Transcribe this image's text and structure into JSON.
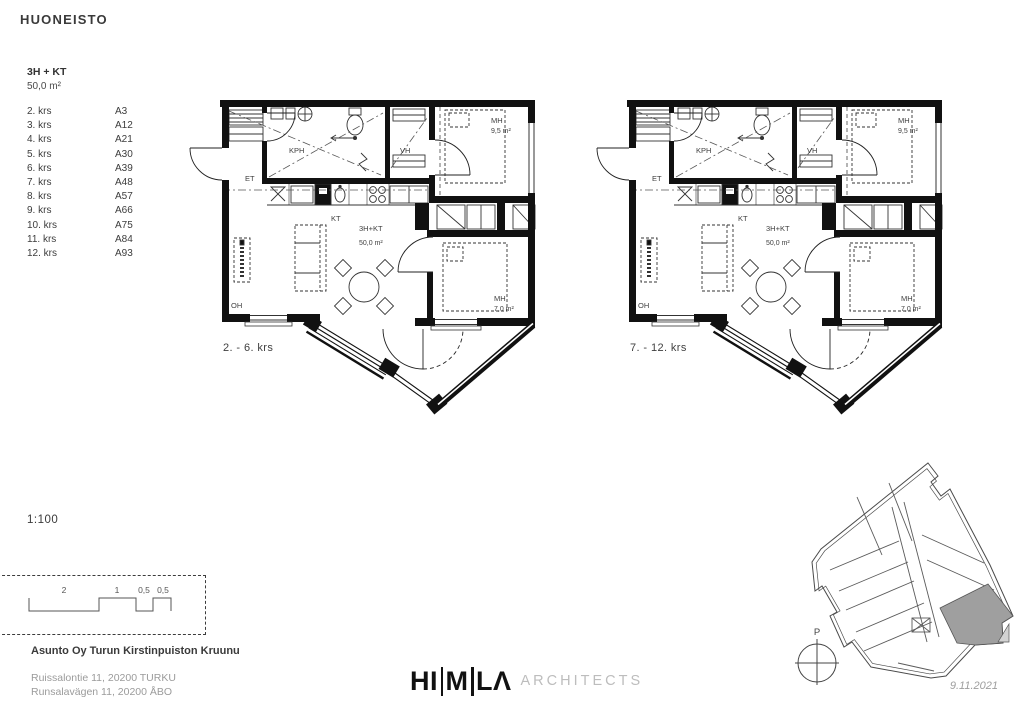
{
  "page": {
    "title": "HUONEISTO",
    "scale_label": "1:100",
    "date": "9.11.2021"
  },
  "unit": {
    "type": "3H + KT",
    "area": "50,0 m²"
  },
  "floors": [
    {
      "floor": "2. krs",
      "apt": "A3"
    },
    {
      "floor": "3. krs",
      "apt": "A12"
    },
    {
      "floor": "4. krs",
      "apt": "A21"
    },
    {
      "floor": "5. krs",
      "apt": "A30"
    },
    {
      "floor": "6. krs",
      "apt": "A39"
    },
    {
      "floor": "7. krs",
      "apt": "A48"
    },
    {
      "floor": "8. krs",
      "apt": "A57"
    },
    {
      "floor": "9. krs",
      "apt": "A66"
    },
    {
      "floor": "10. krs",
      "apt": "A75"
    },
    {
      "floor": "11. krs",
      "apt": "A84"
    },
    {
      "floor": "12. krs",
      "apt": "A93"
    }
  ],
  "plans": [
    {
      "caption": "2. - 6. krs",
      "rooms": {
        "kph": "KPH",
        "vh": "VH",
        "et": "ET",
        "kt": "KT",
        "unit": "3H+KT",
        "unit_area": "50,0 m²",
        "mh_top": "MH",
        "mh_top_area": "9,5 m²",
        "mh_bottom": "MH",
        "mh_bottom_area": "7,0 m²",
        "oh": "OH"
      }
    },
    {
      "caption": "7. - 12. krs",
      "rooms": {
        "kph": "KPH",
        "vh": "VH",
        "et": "ET",
        "kt": "KT",
        "unit": "3H+KT",
        "unit_area": "50,0 m²",
        "mh_top": "MH",
        "mh_top_area": "9,5 m²",
        "mh_bottom": "MH",
        "mh_bottom_area": "7,0 m²",
        "oh": "OH"
      }
    }
  ],
  "scale_bar": {
    "labels": [
      "2",
      "1",
      "0,5",
      "0,5"
    ]
  },
  "project": {
    "name": "Asunto Oy Turun Kirstinpuiston Kruunu",
    "address_line1": "Ruissalontie 11, 20200 TURKU",
    "address_line2": "Runsalavägen 11, 20200 ÅBO"
  },
  "logo": {
    "part1": "HI",
    "part2": "M",
    "part3": "LΛ",
    "suffix": "ARCHITECTS"
  },
  "site_plan": {
    "north_label": "P"
  },
  "colors": {
    "ink": "#111111",
    "text": "#3c3c3c",
    "muted": "#9b9b9b",
    "logo_gray": "#bdbdbd",
    "highlight_unit": "#9f9f9f"
  }
}
